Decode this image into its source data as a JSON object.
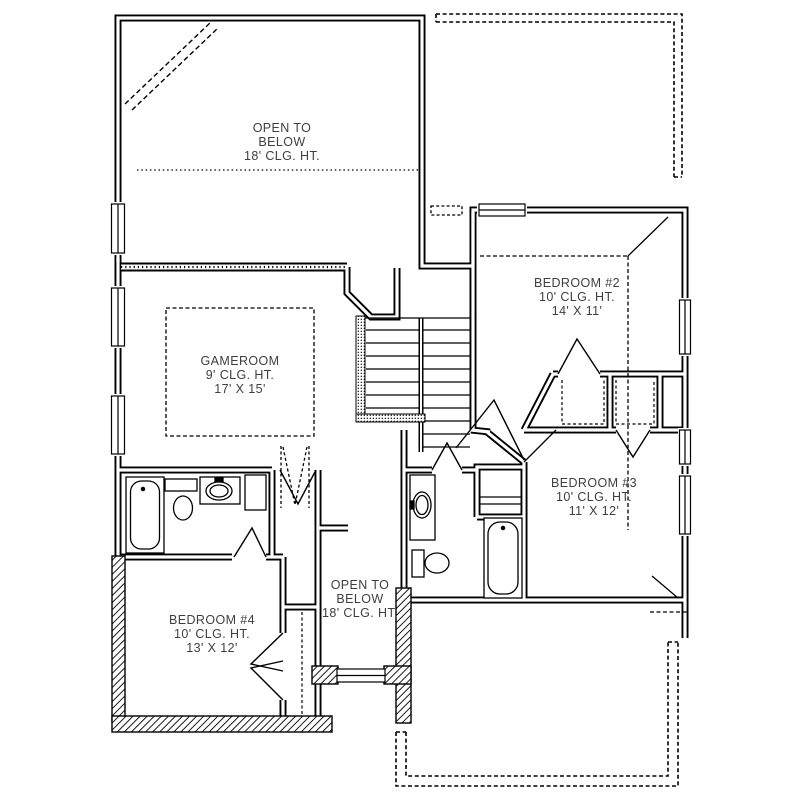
{
  "drawing": {
    "type": "second-floor-residential-floor-plan",
    "colors": {
      "line": "#000000",
      "text": "#3f3f3f",
      "background": "#ffffff"
    }
  },
  "rooms": [
    {
      "name": "open-to-below-top",
      "lines": [
        "OPEN TO",
        "BELOW",
        "18' CLG. HT."
      ]
    },
    {
      "name": "gameroom",
      "lines": [
        "GAMEROOM",
        "9' CLG. HT.",
        "17' X 15'"
      ]
    },
    {
      "name": "bedroom-2",
      "lines": [
        "BEDROOM #2",
        "10' CLG. HT.",
        "14' X 11'"
      ]
    },
    {
      "name": "bedroom-3",
      "lines": [
        "BEDROOM #3",
        "10' CLG. HT.",
        "11' X 12'"
      ]
    },
    {
      "name": "bedroom-4",
      "lines": [
        "BEDROOM #4",
        "10' CLG. HT.",
        "13' X 12'"
      ]
    },
    {
      "name": "open-to-below-bottom",
      "lines": [
        "OPEN TO",
        "BELOW",
        "18' CLG. HT."
      ]
    }
  ],
  "fixtures": [
    "bathtub",
    "toilet",
    "sink-vanity",
    "linen-closet",
    "staircase",
    "attic-access",
    "french-doors",
    "windows",
    "roof-outline"
  ]
}
